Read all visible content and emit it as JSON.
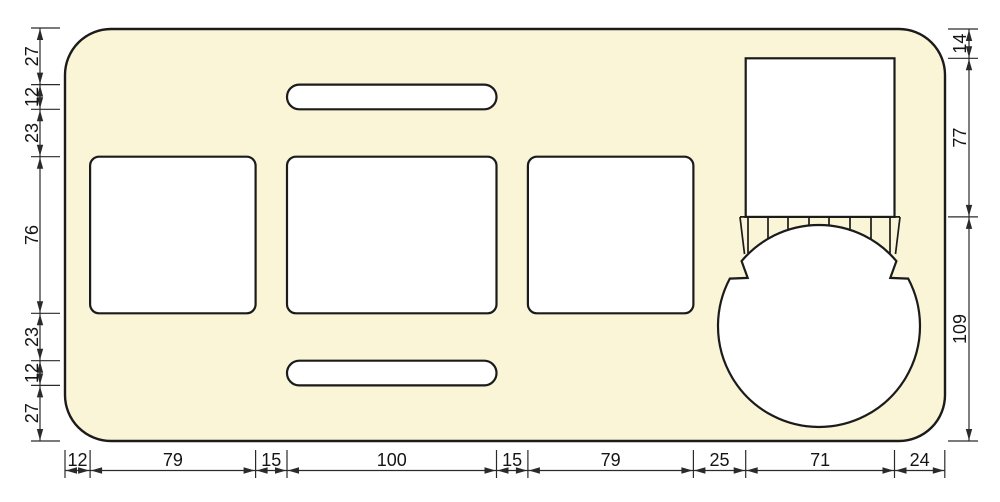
{
  "drawing": {
    "type": "panel-cutout-dimension-drawing",
    "dimensions": {
      "left": [
        "27",
        "12",
        "23",
        "76",
        "23",
        "12",
        "27"
      ],
      "right": [
        "14",
        "77",
        "109"
      ],
      "bottom": [
        "12",
        "79",
        "15",
        "100",
        "15",
        "79",
        "25",
        "71",
        "24"
      ]
    },
    "colors": {
      "background": "#FFFFFF",
      "panel_fill": "#FAF5D7",
      "cutout_fill": "#FFFFFF",
      "outline": "#1B1B1B",
      "dimension_line": "#2A2A2A"
    }
  }
}
